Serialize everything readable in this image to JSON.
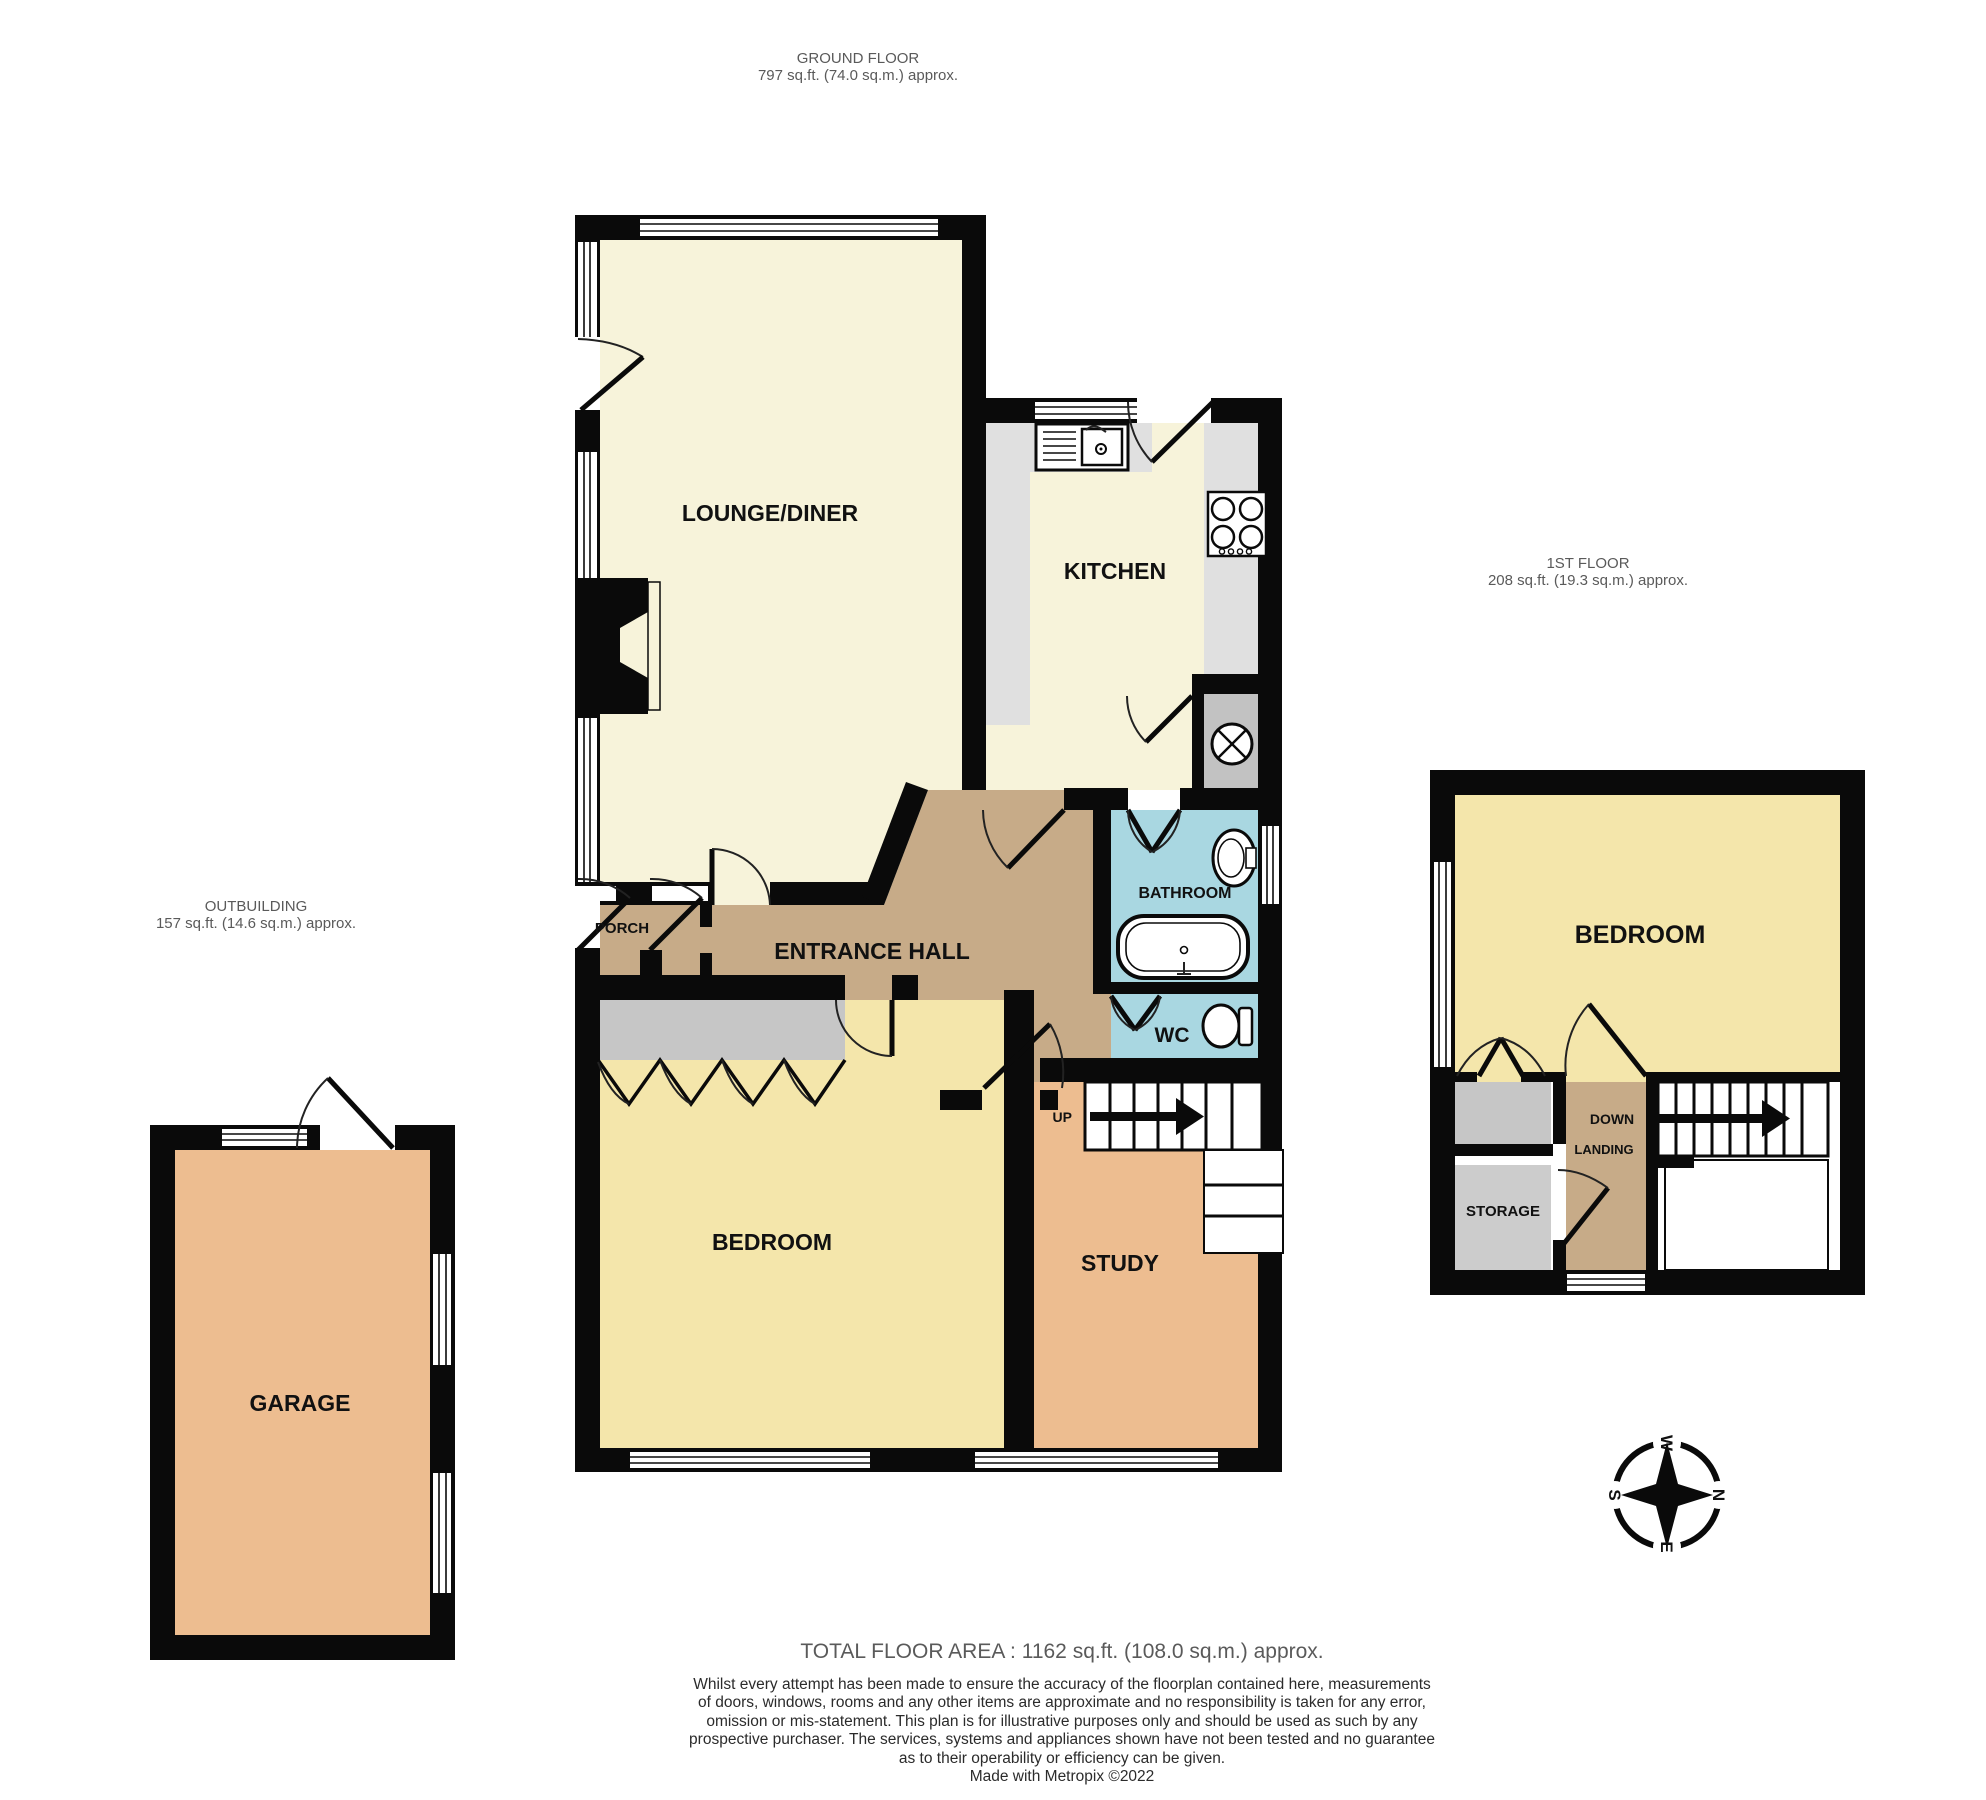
{
  "header_labels": {
    "ground": {
      "title": "GROUND FLOOR",
      "area": "797 sq.ft. (74.0 sq.m.) approx."
    },
    "first": {
      "title": "1ST FLOOR",
      "area": "208 sq.ft. (19.3 sq.m.) approx."
    },
    "outbuilding": {
      "title": "OUTBUILDING",
      "area": "157 sq.ft. (14.6 sq.m.) approx."
    }
  },
  "rooms": {
    "lounge": "LOUNGE/DINER",
    "kitchen": "KITCHEN",
    "entrance_hall": "ENTRANCE HALL",
    "porch": "PORCH",
    "bathroom": "BATHROOM",
    "wc": "WC",
    "bedroom_ground": "BEDROOM",
    "study": "STUDY",
    "bedroom_first": "BEDROOM",
    "landing": "LANDING",
    "storage": "STORAGE",
    "garage": "GARAGE"
  },
  "stairs": {
    "up": "UP",
    "down": "DOWN"
  },
  "compass": {
    "n": "N",
    "e": "E",
    "s": "S",
    "w": "W"
  },
  "footer": {
    "total_area": "TOTAL FLOOR AREA : 1162 sq.ft. (108.0 sq.m.) approx.",
    "disclaimer_lines": [
      "Whilst every attempt has been made to ensure the accuracy of the floorplan contained here, measurements",
      "of doors, windows, rooms and any other items are approximate and no responsibility is taken for any error,",
      "omission or mis-statement. This plan is for illustrative purposes only and should be used as such by any",
      "prospective purchaser. The services, systems and appliances shown have not been tested and no guarantee",
      "as to their operability or efficiency can be given."
    ],
    "credit": "Made with Metropix ©2022"
  },
  "colors": {
    "wall": "#0a0a0a",
    "lounge_kitchen_cream": "#f7f3da",
    "bedroom_yellow": "#f4e6ab",
    "hall_tan": "#c7ab88",
    "study_garage_orange": "#edbd90",
    "bath_blue": "#a9d7e1",
    "counter_gray": "#e0e0e0",
    "utility_gray": "#c2c2c2",
    "wardrobe_gray": "#c6c6c6",
    "storage_gray": "#cccccc"
  }
}
